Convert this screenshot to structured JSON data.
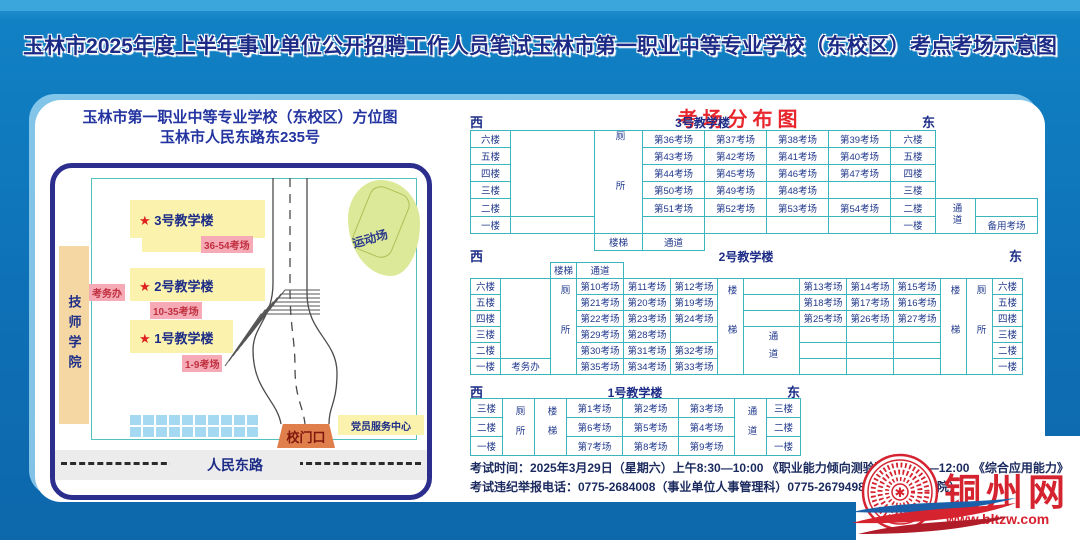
{
  "title": "玉林市2025年度上半年事业单位公开招聘工作人员笔试玉林市第一职业中等专业学校（东校区）考点考场示意图",
  "colors": {
    "background_blue": "#0e70b6",
    "title_navy": "#1c2b85",
    "table_border_teal": "#3ab6bc",
    "distribution_title_red": "#e8262d",
    "building_yellow": "#fbf3ad",
    "tag_pink": "#f5aab5",
    "gate_orange": "#e07e4c",
    "logo_red": "#d5232f"
  },
  "map": {
    "title1": "玉林市第一职业中等专业学校（东校区）方位图",
    "title2": "玉林市人民东路东235号",
    "star": "★",
    "jishi": "技师学院",
    "sports": "运动场",
    "b3_label": "3号教学楼",
    "b3_tag": "36-54考场",
    "b2_label": "2号教学楼",
    "b2_tag": "10-35考场",
    "kaowuban": "考务办",
    "b1_label": "1号教学楼",
    "b1_tag": "1-9考场",
    "gate": "校门口",
    "party": "党员服务中心",
    "road": "人民东路"
  },
  "distribution": {
    "title": "考场分布图",
    "b3": {
      "west": "西",
      "east": "东",
      "name": "3号教学楼",
      "floors": [
        "六楼",
        "五楼",
        "四楼",
        "三楼",
        "二楼",
        "一楼"
      ],
      "wc": "厕所",
      "stairs": "楼梯",
      "passage": "通道",
      "passage_right": "通道",
      "backup": "备用考场",
      "rows": [
        [
          "第36考场",
          "第37考场",
          "第38考场",
          "第39考场"
        ],
        [
          "第43考场",
          "第42考场",
          "第41考场",
          "第40考场"
        ],
        [
          "第44考场",
          "第45考场",
          "第46考场",
          "第47考场"
        ],
        [
          "第50考场",
          "第49考场",
          "第48考场",
          ""
        ],
        [
          "第51考场",
          "第52考场",
          "第53考场",
          "第54考场"
        ],
        [
          "",
          "",
          "",
          ""
        ]
      ]
    },
    "b2": {
      "west": "西",
      "east": "东",
      "name": "2号教学楼",
      "floors": [
        "六楼",
        "五楼",
        "四楼",
        "三楼",
        "二楼",
        "一楼"
      ],
      "stairs_top": "楼梯",
      "passage_top": "通道",
      "wc_west": "厕所",
      "wc_east": "厕所",
      "stairs_west": "楼梯",
      "stairs_east": "楼梯",
      "passage": "通道",
      "kaowuban": "考务办",
      "west_rows": [
        [
          "第10考场",
          "第11考场",
          "第12考场"
        ],
        [
          "第21考场",
          "第20考场",
          "第19考场"
        ],
        [
          "第22考场",
          "第23考场",
          "第24考场"
        ],
        [
          "第29考场",
          "第28考场",
          ""
        ],
        [
          "第30考场",
          "第31考场",
          "第32考场"
        ],
        [
          "第35考场",
          "第34考场",
          "第33考场"
        ]
      ],
      "east_rows": [
        [
          "第13考场",
          "第14考场",
          "第15考场"
        ],
        [
          "第18考场",
          "第17考场",
          "第16考场"
        ],
        [
          "第25考场",
          "第26考场",
          "第27考场"
        ],
        [
          "",
          "",
          ""
        ],
        [
          "",
          "",
          ""
        ],
        [
          "",
          "",
          ""
        ]
      ]
    },
    "b1": {
      "west": "西",
      "east": "东",
      "name": "1号教学楼",
      "floors": [
        "三楼",
        "二楼",
        "一楼"
      ],
      "wc": "厕所",
      "stairs": "楼梯",
      "passage": "通道",
      "rows": [
        [
          "第1考场",
          "第2考场",
          "第3考场"
        ],
        [
          "第6考场",
          "第5考场",
          "第4考场"
        ],
        [
          "第7考场",
          "第8考场",
          "第9考场"
        ]
      ]
    }
  },
  "info": {
    "line1": "考试时间：2025年3月29日（星期六）上午8:30—10:00 《职业能力倾向测验》　 10:00—12:00 《综合应用能力》",
    "line2": "考试违纪举报电话：0775-2684008（事业单位人事管理科）0775-2679498（市人事考试院）"
  },
  "logo": {
    "name": "铜州网",
    "url": "www.bltzw.com"
  }
}
